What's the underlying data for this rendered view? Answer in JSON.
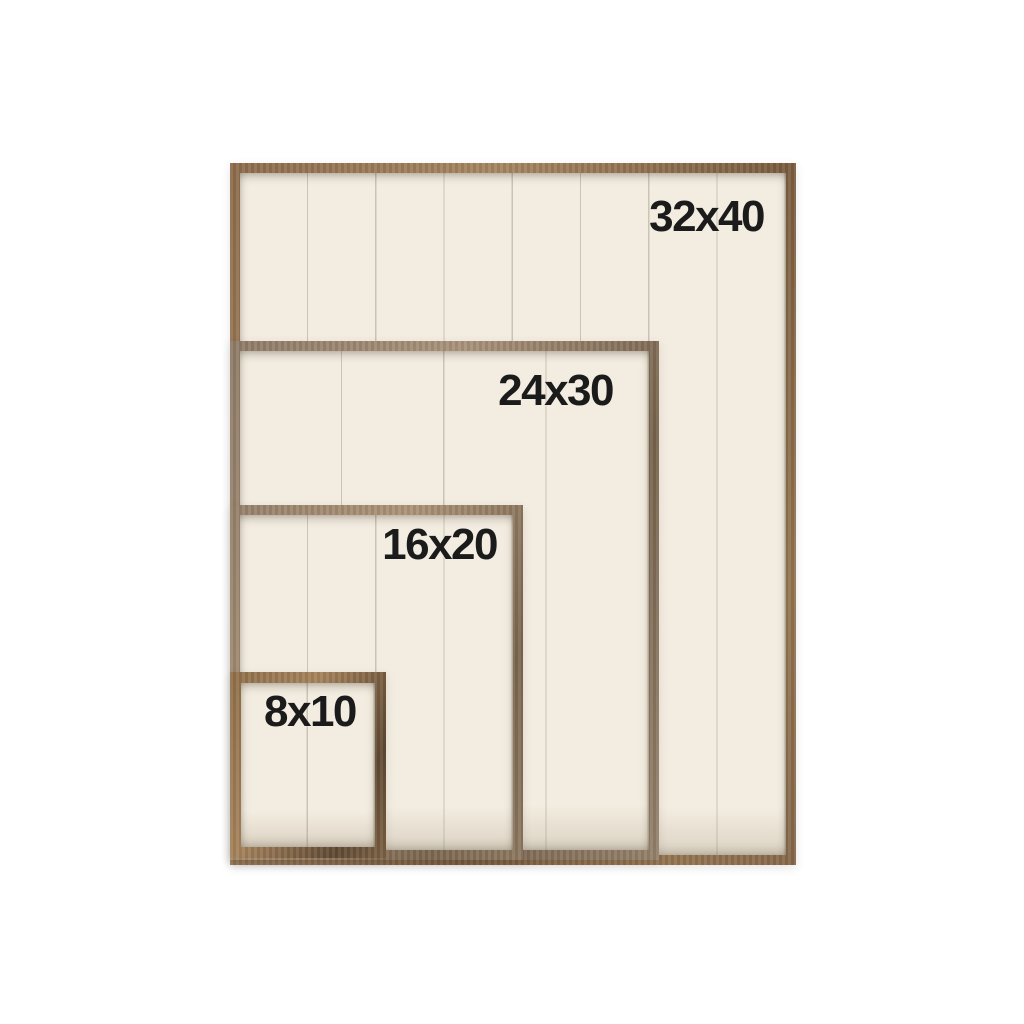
{
  "scene": {
    "background_color": "#ffffff"
  },
  "signs": [
    {
      "label": "32x40",
      "width_in": 32,
      "height_in": 40,
      "planks": 8
    },
    {
      "label": "24x30",
      "width_in": 24,
      "height_in": 30,
      "planks": 4
    },
    {
      "label": "16x20",
      "width_in": 16,
      "height_in": 20,
      "planks": 4
    },
    {
      "label": "8x10",
      "width_in": 8,
      "height_in": 10,
      "planks": 2
    }
  ],
  "colors": {
    "frame_wood": "#8a6a4b",
    "frame_wood_dark": "#6d5138",
    "frame_wood_light": "#a98a64",
    "panel": "#f3ede1",
    "plank_seam": "#c9c4b4",
    "label_text": "#1b1b1b"
  }
}
